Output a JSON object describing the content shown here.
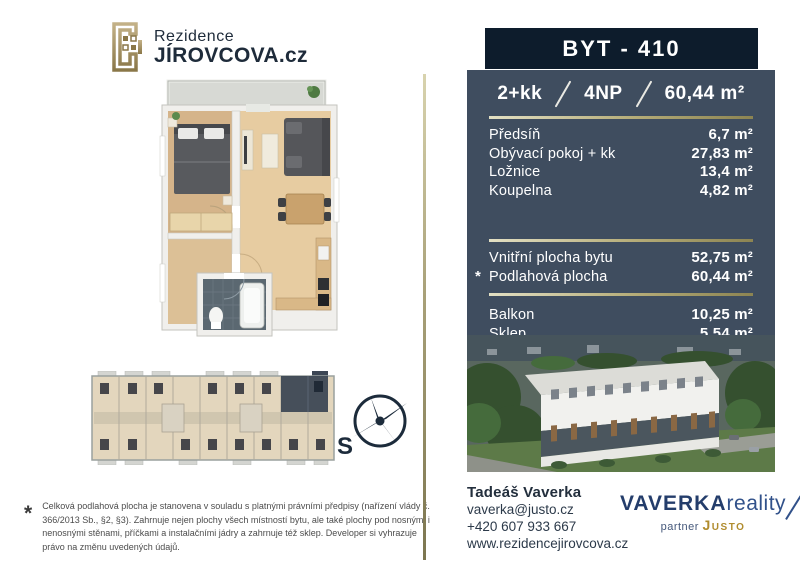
{
  "brand": {
    "line1": "Rezidence",
    "line2": "JÍROVCOVA.cz"
  },
  "unit": {
    "title": "BYT - 410",
    "disposition": "2+kk",
    "floor": "4NP",
    "area": "60,44 m²"
  },
  "rooms": [
    {
      "label": "Předsíň",
      "value": "6,7 m²"
    },
    {
      "label": "Obývací pokoj + kk",
      "value": "27,83 m²"
    },
    {
      "label": "Ložnice",
      "value": "13,4 m²"
    },
    {
      "label": "Koupelna",
      "value": "4,82 m²"
    }
  ],
  "totals": [
    {
      "marker": "",
      "label": "Vnitřní plocha bytu",
      "value": "52,75 m²"
    },
    {
      "marker": "*",
      "label": "Podlahová plocha",
      "value": "60,44 m²"
    }
  ],
  "extras": [
    {
      "label": "Balkon",
      "value": "10,25 m²"
    },
    {
      "label": "Sklep",
      "value": "5,54 m²"
    }
  ],
  "compass": {
    "label": "S"
  },
  "footnote": {
    "marker": "*",
    "text": "Celková podlahová plocha je stanovena v souladu s platnými právními předpisy (nařízení vlády č. 366/2013 Sb., §2, §3). Zahrnuje nejen plochy všech místností bytu, ale také plochy pod nosnými i nenosnými stěnami, příčkami a instalačními jádry a zahrnuje též sklep. Developer si vyhrazuje právo na změnu uvedených údajů."
  },
  "contact": {
    "name": "Tadeáš Vaverka",
    "email": "vaverka@justo.cz",
    "phone": "+420 607 933 667",
    "web": "www.rezidencejirovcova.cz"
  },
  "agency": {
    "name_bold": "VAVERKA",
    "name_light": "reality",
    "partner_label": "partner",
    "partner_name": "Justo"
  },
  "colors": {
    "header_navy": "#0d1c2c",
    "panel_slate": "#3f4d5f",
    "gold_line": "#b5ac78",
    "brand_navy": "#1e2b3a",
    "logo_gold": "#a08c4a",
    "justo_gold": "#b08c2e"
  }
}
